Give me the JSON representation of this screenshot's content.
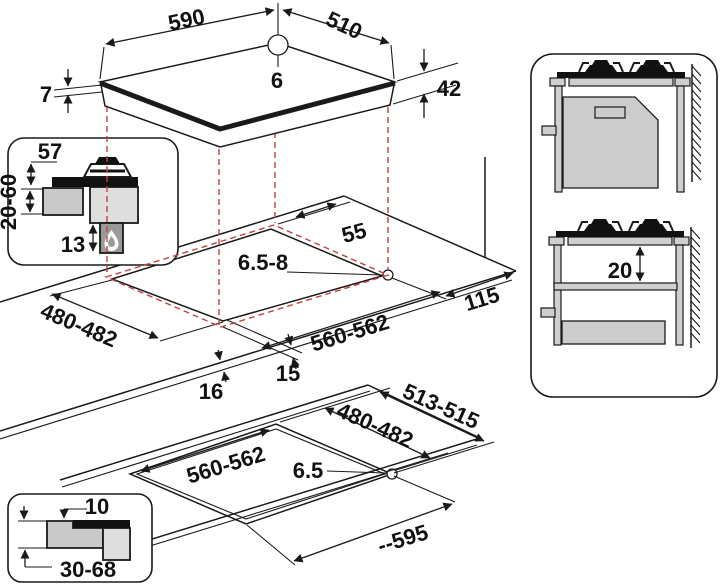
{
  "colors": {
    "line": "#1a1a1a",
    "projection_red": "#c84040",
    "worktop_gray": "#c9c9c9",
    "hob_body_gray": "#dedede",
    "cabinet_gray": "#cfcfcf",
    "gas_box_gray": "#9a9a9a"
  },
  "hob": {
    "width_label": "590",
    "depth_label": "510",
    "hole_diameter": "6",
    "glass_thickness": "7",
    "body_height": "42"
  },
  "gas_section_detail": {
    "burner_height": "57",
    "worktop_thickness": "20-60",
    "bottom_clearance": "13"
  },
  "worktop_cutout": {
    "rear_clearance": "55",
    "corner_radius": "6.5-8",
    "side_clearance": "115",
    "cutout_depth": "480-482",
    "cutout_width": "560-562",
    "overhang_front": "15",
    "overhang_side": "16"
  },
  "cabinet_views": {
    "shelf_clearance": "20"
  },
  "flush_cutout": {
    "outer_depth": "513-515",
    "inner_depth": "480-482",
    "inner_width": "560-562",
    "corner_radius": "6.5",
    "overall_width": "--595"
  },
  "flush_section_detail": {
    "step_depth": "10",
    "worktop_thickness": "30-68"
  },
  "icons": {
    "flame": "gas-flame-icon"
  }
}
